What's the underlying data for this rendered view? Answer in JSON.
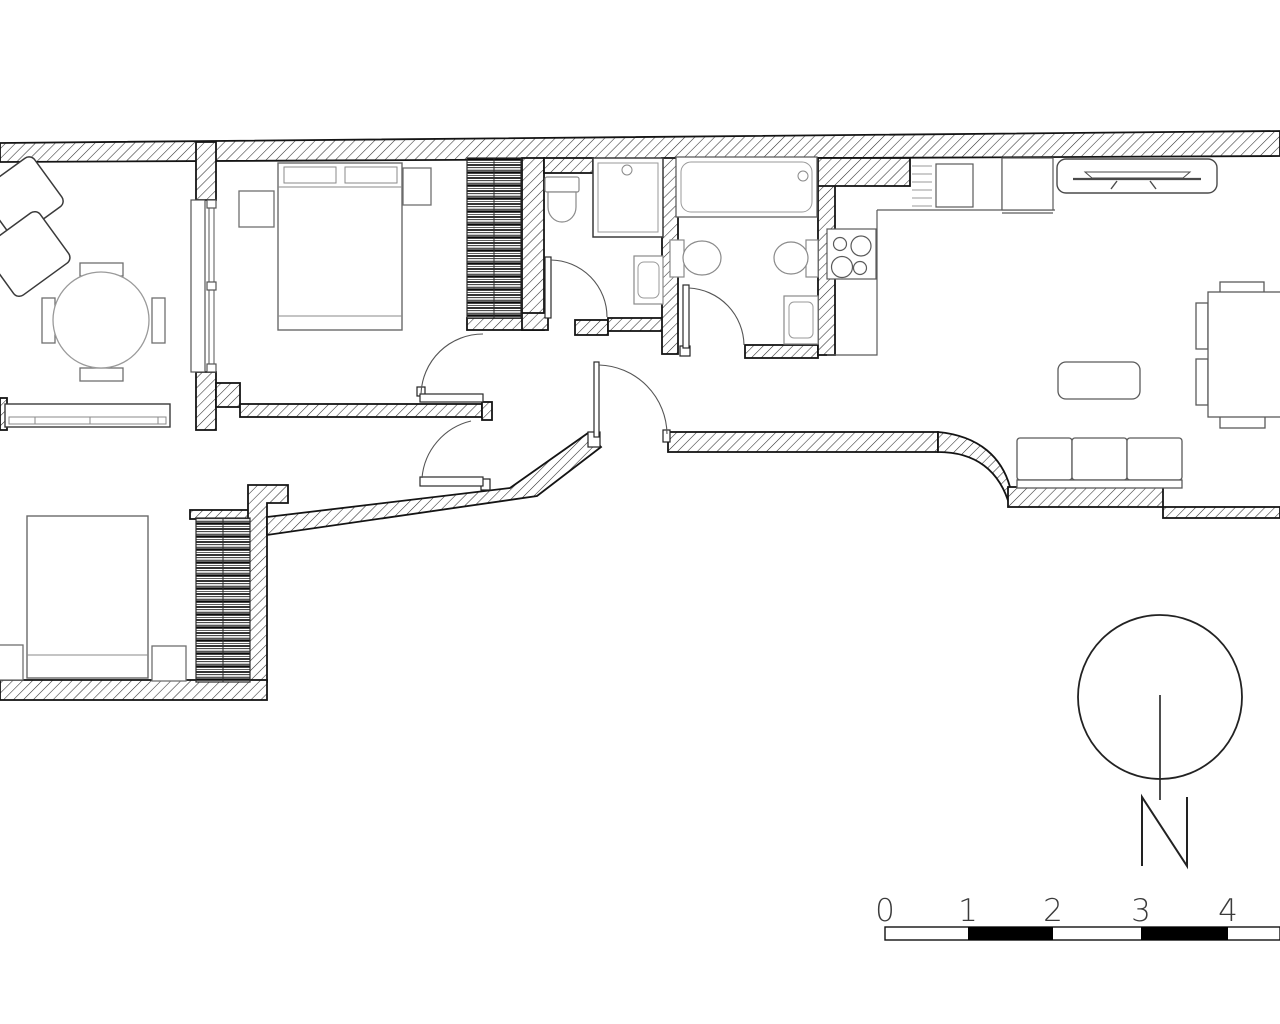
{
  "drawing": {
    "kind": "apartment floor plan, line drawing, hatched walls",
    "background": "#ffffff"
  },
  "colors": {
    "wall_line": "#141414",
    "hatch_line": "#2e2e2e",
    "furniture_line": "#6f6f6f",
    "fixture_line": "#8a8a8a",
    "door_line": "#3c3c3c",
    "scale_black": "#000000",
    "label_gray": "#3b3b3b"
  },
  "north": {
    "label": "N"
  },
  "scale_bar": {
    "labels": [
      "0",
      "1",
      "2",
      "3",
      "4"
    ],
    "pattern": "alternating white and black meter segments, fifth segment cut by page edge"
  },
  "rooms": {
    "sitting_room": [
      "armchair",
      "armchair",
      "round-table",
      "chair",
      "chair",
      "chair",
      "chair",
      "window"
    ],
    "bedroom_top": [
      "double-bed",
      "pillow",
      "pillow",
      "nightstand",
      "nightstand",
      "wardrobe",
      "sliding-partition"
    ],
    "bathroom_small": [
      "toilet",
      "shower-tray",
      "washbasin",
      "door"
    ],
    "bathroom_large": [
      "bathtub",
      "toilet",
      "bidet",
      "washbasin",
      "door"
    ],
    "kitchen": [
      "hob-4-burners",
      "counter",
      "drainer",
      "sink",
      "appliance-unit"
    ],
    "living_dining": [
      "tv-console",
      "tv",
      "coffee-table",
      "sofa-3-seat",
      "dining-table",
      "chair",
      "chair",
      "chair",
      "chair"
    ],
    "bedroom_bottom": [
      "double-bed",
      "nightstand",
      "nightstand",
      "wardrobe"
    ],
    "hall": [
      "entry-door",
      "bedroom-door",
      "corridor-door"
    ]
  }
}
